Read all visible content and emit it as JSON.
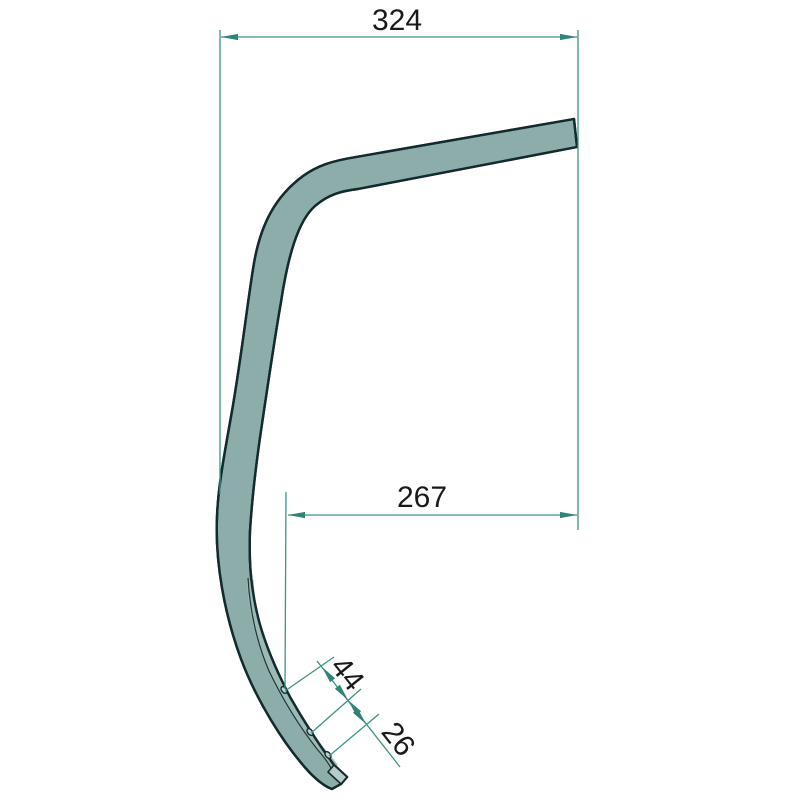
{
  "drawing": {
    "background_color": "#ffffff",
    "part": {
      "name": "curved-spring-tine-profile",
      "fill_color": "#8cadaa",
      "outline_color": "#142b2e",
      "hole_count": 3
    },
    "dimension_style": {
      "line_color": "#3f9286",
      "arrow_color": "#2e8577",
      "text_color": "#1a1a1a"
    },
    "dimensions": [
      {
        "id": "overall-horizontal-width",
        "value": "324",
        "orientation": "horizontal"
      },
      {
        "id": "hole-to-end-horizontal",
        "value": "267",
        "orientation": "horizontal"
      },
      {
        "id": "hole-spacing-outer",
        "value": "44",
        "orientation": "aligned"
      },
      {
        "id": "hole-spacing-inner",
        "value": "26",
        "orientation": "aligned"
      }
    ]
  }
}
